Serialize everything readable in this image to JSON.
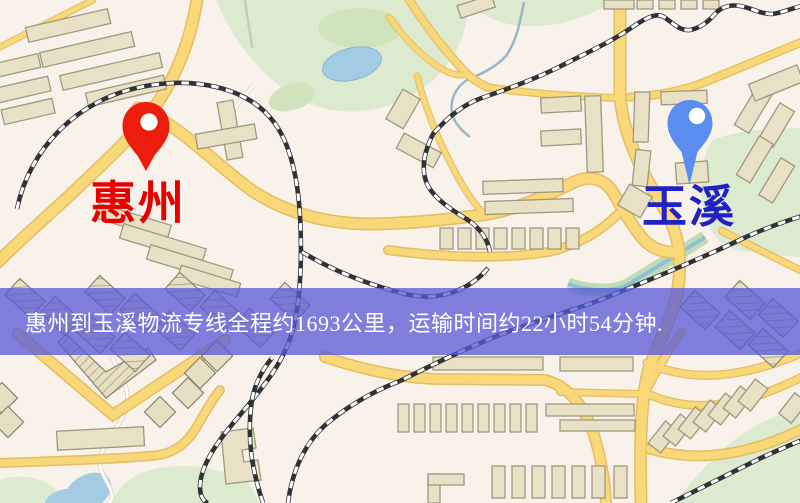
{
  "map": {
    "origin_marker": {
      "label": "惠州",
      "pin_color": "#ee1c0c",
      "label_color": "#e60000"
    },
    "destination_marker": {
      "label": "玉溪",
      "pin_color": "#5b8cf0",
      "label_color": "#2121c4"
    },
    "banner": {
      "text": "惠州到玉溪物流专线全程约1693公里，运输时间约22小时54分钟.",
      "origin": "惠州",
      "destination": "玉溪",
      "distance": "1693公里",
      "duration": "22小时54分钟",
      "background_color": "#585ad8",
      "text_color": "#ffffff"
    },
    "colors": {
      "map_background": "#f8f2ea",
      "road_fill": "#f8d878",
      "road_casing": "#e5bd62",
      "building": "#e9e1c6",
      "green_area": "#dcead0",
      "water": "#a3cce4",
      "railway": "#303234"
    }
  }
}
